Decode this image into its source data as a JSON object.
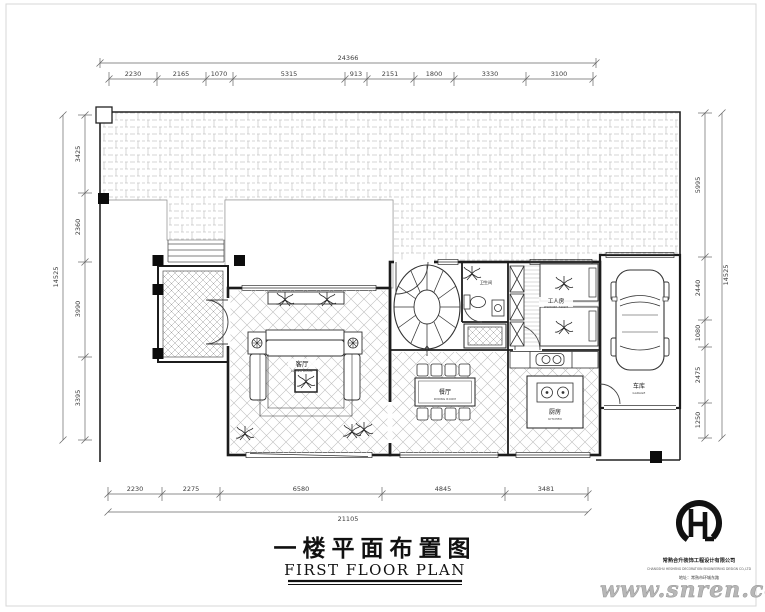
{
  "title": {
    "zh": "一楼平面布置图",
    "en": "FIRST FLOOR PLAN"
  },
  "watermark": "www.snren.com",
  "logo": {
    "company_zh": "常熟合升装饰工程设计有限公司",
    "company_en": "CHANGSHU HESHENG DECORATION ENGINEERING DESIGN CO.,LTD",
    "address": "地址：常熟市环城东路"
  },
  "rooms": {
    "living": {
      "zh": "客厅",
      "en": "LIVING ROOM"
    },
    "dining": {
      "zh": "餐厅",
      "en": "DINING ROOM"
    },
    "kitchen": {
      "zh": "厨房",
      "en": "KITCHEN"
    },
    "garage": {
      "zh": "车库",
      "en": "GARAGE"
    },
    "worker": {
      "zh": "工人房",
      "en": "WORKER ROOM"
    },
    "bath": {
      "zh": "卫生间",
      "en": "TOILET"
    }
  },
  "dimensions": {
    "top": {
      "total": "24366",
      "segments": [
        "2230",
        "2165",
        "1070",
        "5315",
        "913",
        "2151",
        "1800",
        "3330",
        "3100"
      ]
    },
    "bottom": {
      "total": "21105",
      "segments": [
        "2230",
        "2275",
        "6580",
        "4845",
        "3481"
      ]
    },
    "left": {
      "total": "14525",
      "segments": [
        "3425",
        "2360",
        "3990",
        "3395"
      ]
    },
    "right": {
      "total": "14525",
      "segments": [
        "5995",
        "2440",
        "1080",
        "2475",
        "1250"
      ]
    }
  }
}
